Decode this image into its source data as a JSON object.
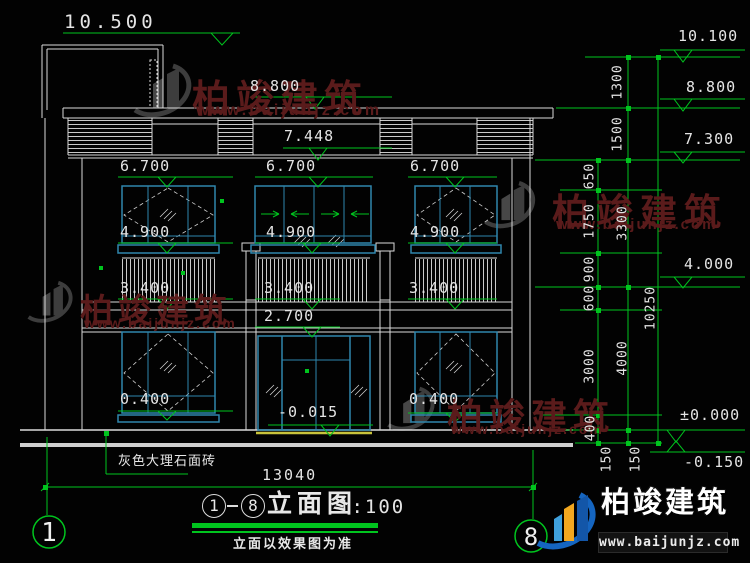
{
  "brand": {
    "name": "柏竣建筑",
    "url": "www.baijunjz.com"
  },
  "title_block": {
    "axis_from": "1",
    "axis_to": "8",
    "name": "立面图",
    "scale": "1:100",
    "note": "立面以效果图为准"
  },
  "axes": {
    "left": "1",
    "right": "8"
  },
  "labels": {
    "material": "灰色大理石面砖"
  },
  "dimensions": {
    "overall_width": "13040",
    "overall_height": "10250",
    "inner_chain": [
      "650",
      "1750",
      "900",
      "600",
      "3000",
      "400",
      "150"
    ],
    "middle_chain": [
      "1300",
      "1500",
      "3300",
      "4000",
      "150"
    ]
  },
  "elevations": {
    "facade": [
      "10.500",
      "8.800",
      "7.448",
      "6.700",
      "6.700",
      "6.700",
      "4.900",
      "4.900",
      "4.900",
      "3.400",
      "3.400",
      "3.400",
      "2.700",
      "0.400",
      "0.400",
      "-0.015"
    ],
    "right": [
      "10.100",
      "8.800",
      "7.300",
      "4.000",
      "±0.000",
      "-0.150"
    ]
  }
}
